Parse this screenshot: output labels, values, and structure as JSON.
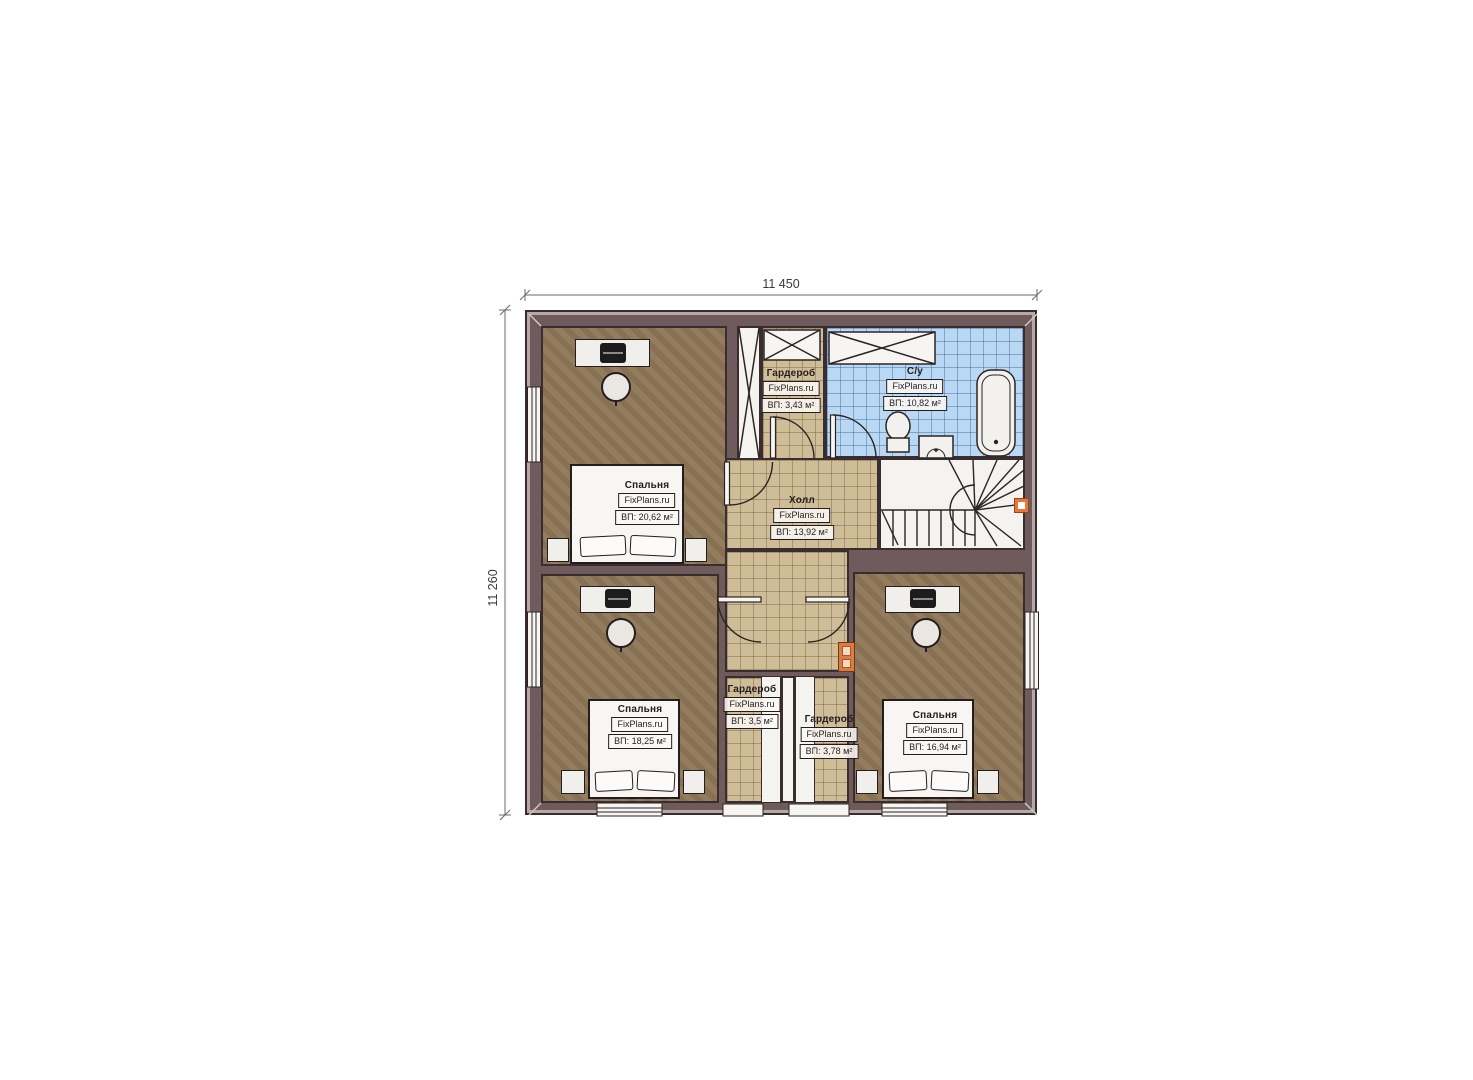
{
  "plan": {
    "title": "floor-plan-second-storey",
    "dimensions": {
      "top": "11 450",
      "left": "11 260"
    },
    "watermark": "FixPlans.ru",
    "rooms": [
      {
        "id": "bedroom-top-left",
        "name": "Спальня",
        "watermark": "FixPlans.ru",
        "area": "ВП: 20,62 м²"
      },
      {
        "id": "wardrobe-top",
        "name": "Гардероб",
        "watermark": "FixPlans.ru",
        "area": "ВП: 3,43 м²"
      },
      {
        "id": "bathroom",
        "name": "С/у",
        "watermark": "FixPlans.ru",
        "area": "ВП: 10,82 м²"
      },
      {
        "id": "hall",
        "name": "Холл",
        "watermark": "FixPlans.ru",
        "area": "ВП: 13,92 м²"
      },
      {
        "id": "bedroom-bottom-left",
        "name": "Спальня",
        "watermark": "FixPlans.ru",
        "area": "ВП: 18,25 м²"
      },
      {
        "id": "wardrobe-bottom-left",
        "name": "Гардероб",
        "watermark": "FixPlans.ru",
        "area": "ВП: 3,5 м²"
      },
      {
        "id": "wardrobe-bottom-right",
        "name": "Гардероб",
        "watermark": "FixPlans.ru",
        "area": "ВП: 3,78 м²"
      },
      {
        "id": "bedroom-bottom-right",
        "name": "Спальня",
        "watermark": "FixPlans.ru",
        "area": "ВП: 16,94 м²"
      }
    ],
    "colors": {
      "wall": "#6f5b5c",
      "floor_bedroom": "#8d7656",
      "tile_hall": "#cfbd98",
      "tile_bath": "#b9d8f3",
      "accent_orange": "#e4793b"
    }
  }
}
